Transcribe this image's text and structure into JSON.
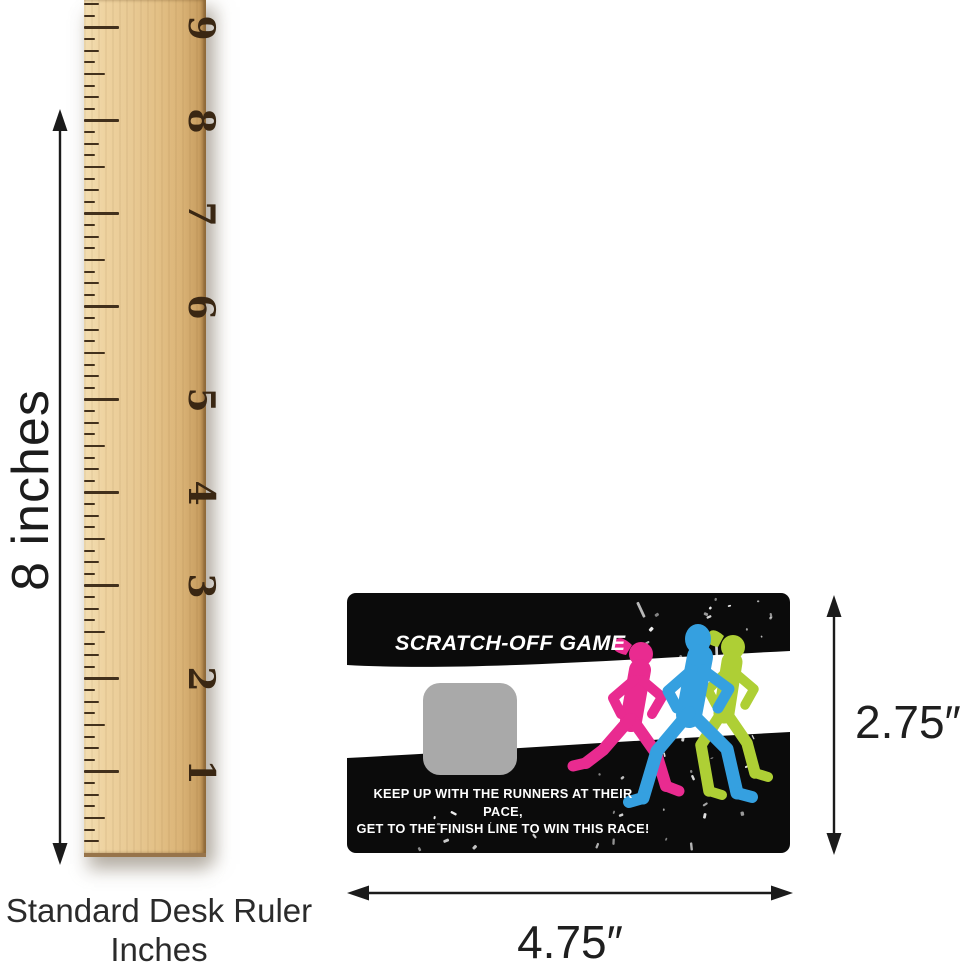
{
  "measurements": {
    "ruler_height_label": "8 inches",
    "card_height_label": "2.75″",
    "card_width_label": "4.75″"
  },
  "ruler": {
    "caption_line1": "Standard Desk Ruler",
    "caption_line2": "Inches",
    "inch_numbers": [
      "1",
      "2",
      "3",
      "4",
      "5",
      "6",
      "7",
      "8",
      "9"
    ]
  },
  "card": {
    "title": "SCRATCH-OFF GAME",
    "tagline_line1": "KEEP UP WITH THE RUNNERS AT THEIR PACE,",
    "tagline_line2": "GET TO THE FINISH LINE TO WIN THIS RACE!",
    "colors": {
      "card_background": "#0b0b0b",
      "band": "#ffffff",
      "scratch_area": "#a9a9a9",
      "runner_pink": "#e92b90",
      "runner_blue": "#35a0e0",
      "runner_green": "#aecf35"
    }
  }
}
